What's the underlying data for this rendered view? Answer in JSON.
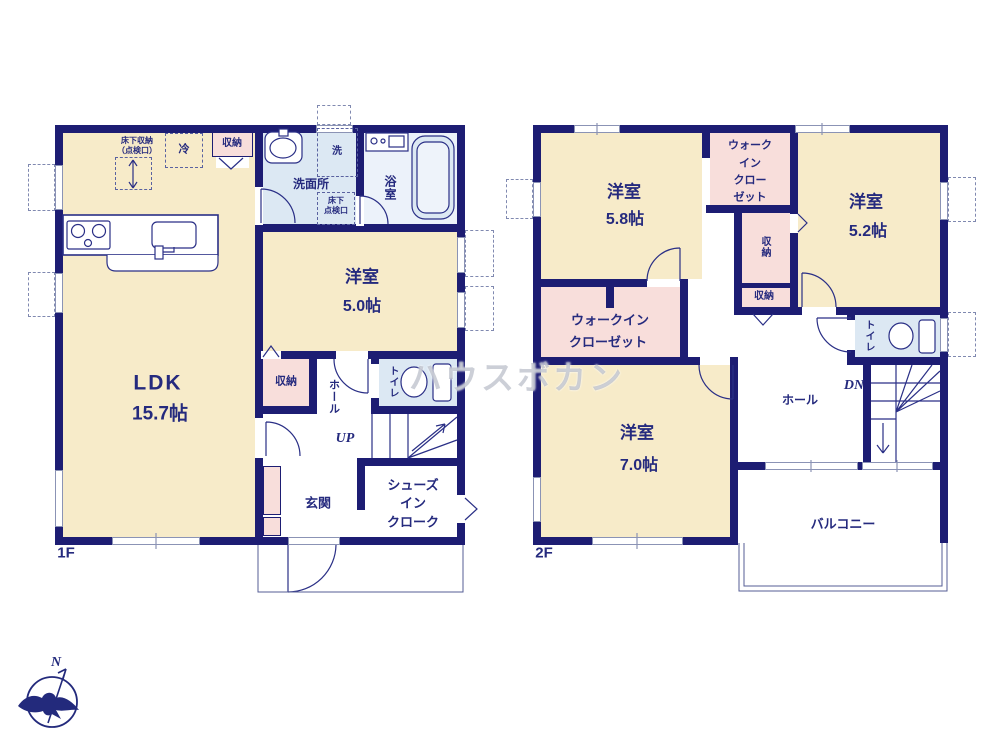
{
  "watermark": "ハウスボカン",
  "compass": {
    "north_label": "N"
  },
  "colors": {
    "wall": "#1d1d73",
    "room_cream": "#f7ebc9",
    "closet_pink": "#f8dedb",
    "wet_blue": "#dce8f3",
    "text_navy": "#252a7e"
  },
  "floor1": {
    "floor_label": "1F",
    "ldk": {
      "name": "LDK",
      "area": "15.7帖"
    },
    "bedroom": {
      "name": "洋室",
      "area": "5.0帖"
    },
    "washroom": "洗面所",
    "bath": "浴室",
    "laundry": "洗",
    "refrigerator": "冷",
    "storage_top": "収納",
    "underfloor_storage_line1": "床下収納",
    "underfloor_storage_line2": "（点検口）",
    "underfloor_hatch_line1": "床下",
    "underfloor_hatch_line2": "点検口",
    "storage_mid": "収納",
    "hall": "ホール",
    "toilet": "トイレ",
    "stairs": "UP",
    "entrance": "玄関",
    "shoes_closet_line1": "シューズ",
    "shoes_closet_line2": "イン",
    "shoes_closet_line3": "クローク"
  },
  "floor2": {
    "floor_label": "2F",
    "bedroom_58": {
      "name": "洋室",
      "area": "5.8帖"
    },
    "bedroom_52": {
      "name": "洋室",
      "area": "5.2帖"
    },
    "bedroom_70": {
      "name": "洋室",
      "area": "7.0帖"
    },
    "wic_top": [
      "ウォーク",
      "イン",
      "クロー",
      "ゼット"
    ],
    "wic_left_line1": "ウォークイン",
    "wic_left_line2": "クローゼット",
    "storage_vertical": "収納",
    "storage_small": "収納",
    "hall": "ホール",
    "toilet": "トイレ",
    "stairs": "DN",
    "balcony": "バルコニー"
  }
}
